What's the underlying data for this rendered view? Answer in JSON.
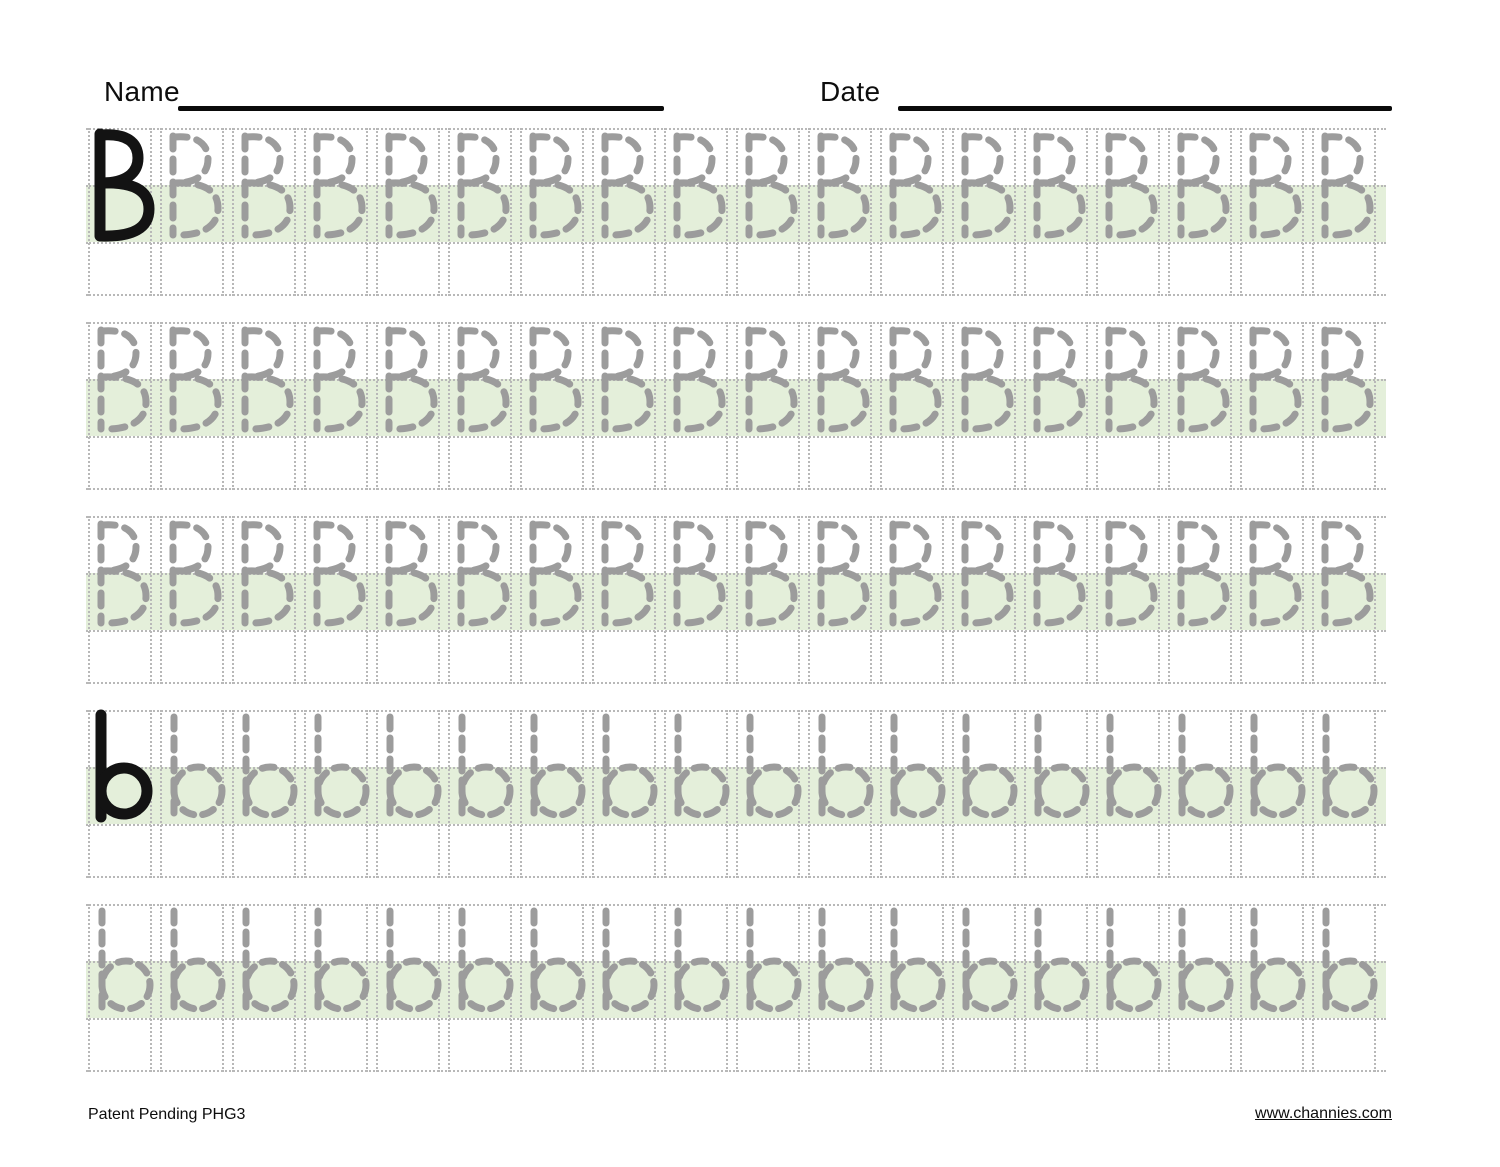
{
  "header": {
    "name_label": "Name",
    "date_label": "Date"
  },
  "footer": {
    "left_text": "Patent Pending PHG3",
    "link_text": "www.channies.com"
  },
  "colors": {
    "band_green": "#e4efda",
    "guide_dot": "#b8b8b8",
    "trace_gray": "#9c9c9c",
    "ink_black": "#131313"
  },
  "worksheet": {
    "letter_uppercase": "B",
    "letter_lowercase": "b",
    "cells_per_row": 18,
    "rows": [
      {
        "case": "upper",
        "solid_first": true
      },
      {
        "case": "upper",
        "solid_first": false
      },
      {
        "case": "upper",
        "solid_first": false
      },
      {
        "case": "lower",
        "solid_first": true
      },
      {
        "case": "lower",
        "solid_first": false
      }
    ]
  }
}
